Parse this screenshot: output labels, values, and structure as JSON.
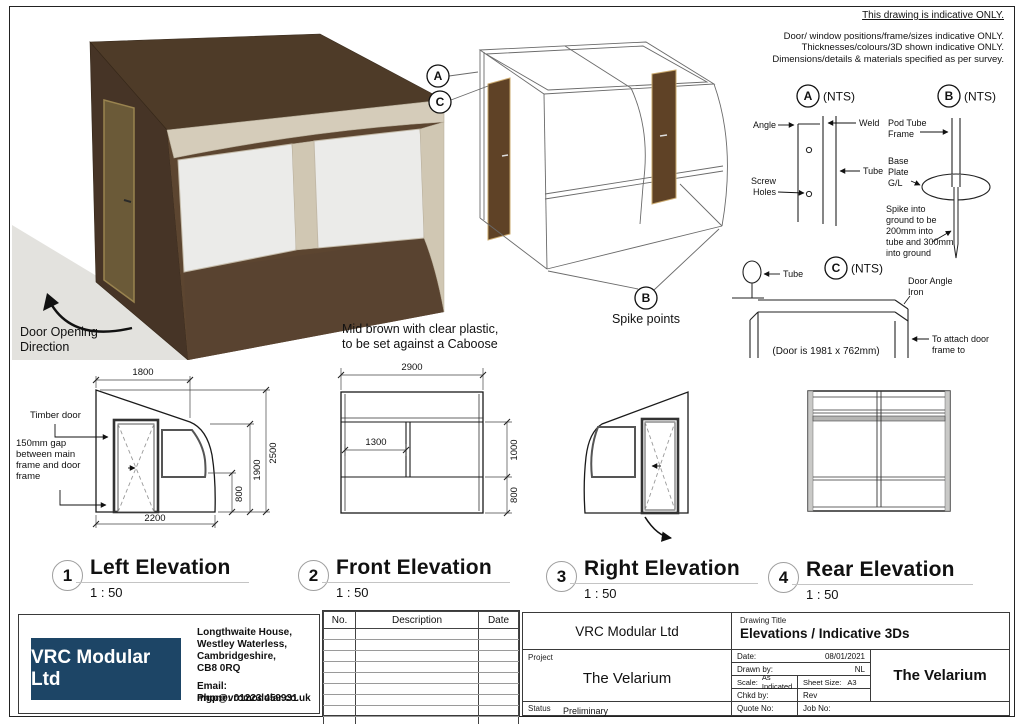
{
  "colors": {
    "logo_navy": "#1d4566",
    "render_roof": "#4e3b28",
    "render_wall": "#463426",
    "render_frame_cream": "#d5ccba",
    "render_door": "#6b5a38"
  },
  "sheet": {
    "disclaimer_title": "This drawing is indicative ONLY.",
    "disclaimer_line1": "Door/ window positions/frame/sizes indicative ONLY.",
    "disclaimer_line2": "Thicknesses/colours/3D shown indicative ONLY.",
    "disclaimer_line3": "Dimensions/details & materials specified as per survey."
  },
  "render": {
    "door_opening_note": "Door Opening\nDirection",
    "material_note": "Mid brown with clear plastic,\nto be set against a Caboose"
  },
  "wireframe": {
    "callout_a": "A",
    "callout_c": "C",
    "callout_b": "B",
    "spike_points": "Spike points"
  },
  "details": {
    "a": {
      "tag": "A",
      "nts": "(NTS)",
      "angle": "Angle",
      "weld": "Weld",
      "tube": "Tube",
      "screw1": "Screw",
      "screw2": "Holes"
    },
    "b": {
      "tag": "B",
      "nts": "(NTS)",
      "pod1": "Pod Tube",
      "pod2": "Frame",
      "base1": "Base",
      "base2": "Plate",
      "base3": "G/L",
      "spike1": "Spike into",
      "spike2": "ground to be",
      "spike3": "200mm into",
      "spike4": "tube and 300mm",
      "spike5": "into ground"
    },
    "c": {
      "tag": "C",
      "nts": "(NTS)",
      "tube": "Tube",
      "iron1": "Door Angle",
      "iron2": "Iron",
      "door_size": "(Door is 1981 x 762mm)",
      "attach1": "To attach door",
      "attach2": "frame to"
    }
  },
  "elevations": [
    {
      "num": "1",
      "title": "Left Elevation",
      "scale": "1 : 50",
      "dim_top": "1800",
      "dim_height": "2500",
      "dim_mid": "1900",
      "dim_low": "800",
      "dim_bottom": "2200",
      "timber_door": "Timber door",
      "gap_note": "150mm gap\nbetween main\nframe and door\nframe"
    },
    {
      "num": "2",
      "title": "Front Elevation",
      "scale": "1 : 50",
      "dim_top": "2900",
      "dim_inner": "1300",
      "dim_up": "1000",
      "dim_low": "800"
    },
    {
      "num": "3",
      "title": "Right Elevation",
      "scale": "1 : 50"
    },
    {
      "num": "4",
      "title": "Rear Elevation",
      "scale": "1 : 50"
    }
  ],
  "titleblock": {
    "company": "VRC Modular Ltd",
    "address": "Longthwaite House,\nWestley Waterless,\nCambridgeshire,\nCB8 0RQ",
    "email": "Email: mgp@vrcmodular.co.uk",
    "phone": "Phone: 01223 459931",
    "rev_no": "No.",
    "rev_desc": "Description",
    "rev_date": "Date",
    "company2": "VRC Modular Ltd",
    "drawing_title_label": "Drawing Title",
    "drawing_title": "Elevations / Indicative 3Ds",
    "project_label": "Project",
    "project": "The Velarium",
    "status_label": "Status",
    "status": "Preliminary",
    "date_label": "Date:",
    "date": "08/01/2021",
    "drawn_label": "Drawn by:",
    "drawn": "NL",
    "scale_label": "Scale:",
    "scale": "As Indicated",
    "sheet_label": "Sheet Size:",
    "sheet": "A3",
    "chkd_label": "Chkd by:",
    "rev_label": "Rev",
    "quote_label": "Quote No:",
    "job_label": "Job No:",
    "project_big": "The Velarium"
  }
}
